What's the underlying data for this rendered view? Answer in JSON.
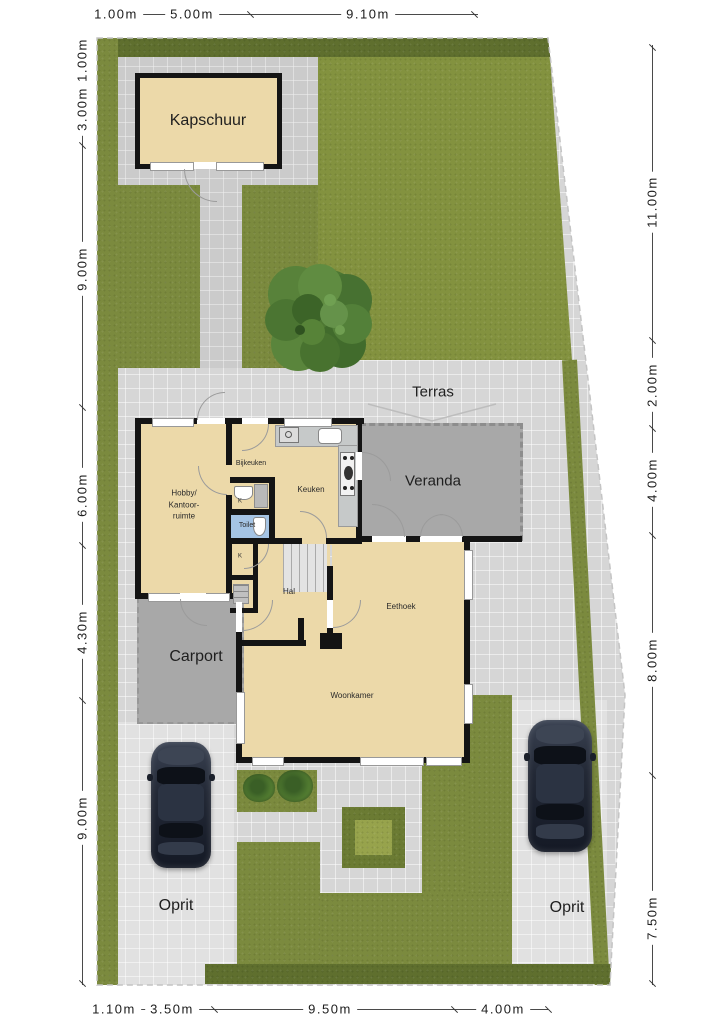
{
  "dimensions": {
    "top": [
      "1.00m",
      "5.00m",
      "9.10m"
    ],
    "left": [
      "1.00m",
      "3.00m",
      "9.00m",
      "6.00m",
      "4.30m",
      "9.00m"
    ],
    "right": [
      "11.00m",
      "2.00m",
      "4.00m",
      "8.00m",
      "7.50m"
    ],
    "bottom": [
      "1.10m",
      "3.50m",
      "9.50m",
      "4.00m"
    ]
  },
  "labels": {
    "kapschuur": "Kapschuur",
    "terras": "Terras",
    "veranda": "Veranda",
    "carport": "Carport",
    "oprit_left": "Oprit",
    "oprit_right": "Oprit",
    "hobby": "Hobby/\nKantoor-\nruimte",
    "bijkeuken": "Bijkeuken",
    "keuken": "Keuken",
    "toilet": "Toilet",
    "hal": "Hal",
    "eethoek": "Eethoek",
    "woonkamer": "Woonkamer",
    "closet_top": "K",
    "closet_bottom": "K"
  },
  "colors": {
    "grass": "#7b8a3e",
    "hedge": "#5f6f2e",
    "paving": "#d6d6d6",
    "floor": "#ecd9a9",
    "wall": "#141414",
    "structure_gray": "#a8a8a8",
    "toilet_blue": "#a5c4e4",
    "car": "#232936"
  }
}
